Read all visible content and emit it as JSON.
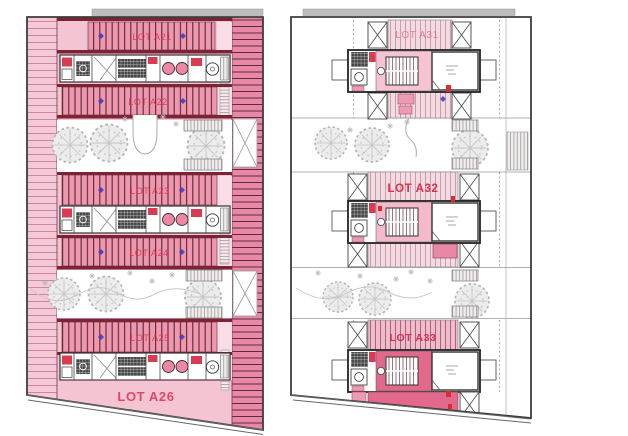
{
  "drawing": {
    "kind": "architectural floor plans, two adjacent building levels",
    "left_plan": {
      "lot_count": 6
    },
    "right_plan": {
      "lot_count": 3
    }
  },
  "plans": [
    {
      "side": "left",
      "lots": [
        {
          "label": "LOT A21"
        },
        {
          "label": "LOT A22"
        },
        {
          "label": "LOT A23"
        },
        {
          "label": "LOT A24"
        },
        {
          "label": "LOT A25"
        },
        {
          "label": "LOT A26"
        }
      ]
    },
    {
      "side": "right",
      "lots": [
        {
          "label": "LOT A31"
        },
        {
          "label": "LOT A32"
        },
        {
          "label": "LOT A33"
        }
      ]
    }
  ],
  "colors": {
    "label_red": "#e32b4c",
    "label_soft": "#ee5f78",
    "label_a26": "#dd4a68",
    "label_dark": "#d81f44",
    "base_pink": "#f5c4d3",
    "stall_pink": "#ee97ae",
    "stripe_dark": "#572836",
    "maroon_bar": "#7c2334",
    "band_pink": "#e987a6",
    "unit_pink": "#f6c3d2",
    "unit_dark_pink": "#e2698b",
    "accent_red": "#d93b52",
    "marker_blue": "#3a3ab8",
    "outline_gray": "#3d3d3d",
    "tree_gray": "#bdbdbd"
  }
}
